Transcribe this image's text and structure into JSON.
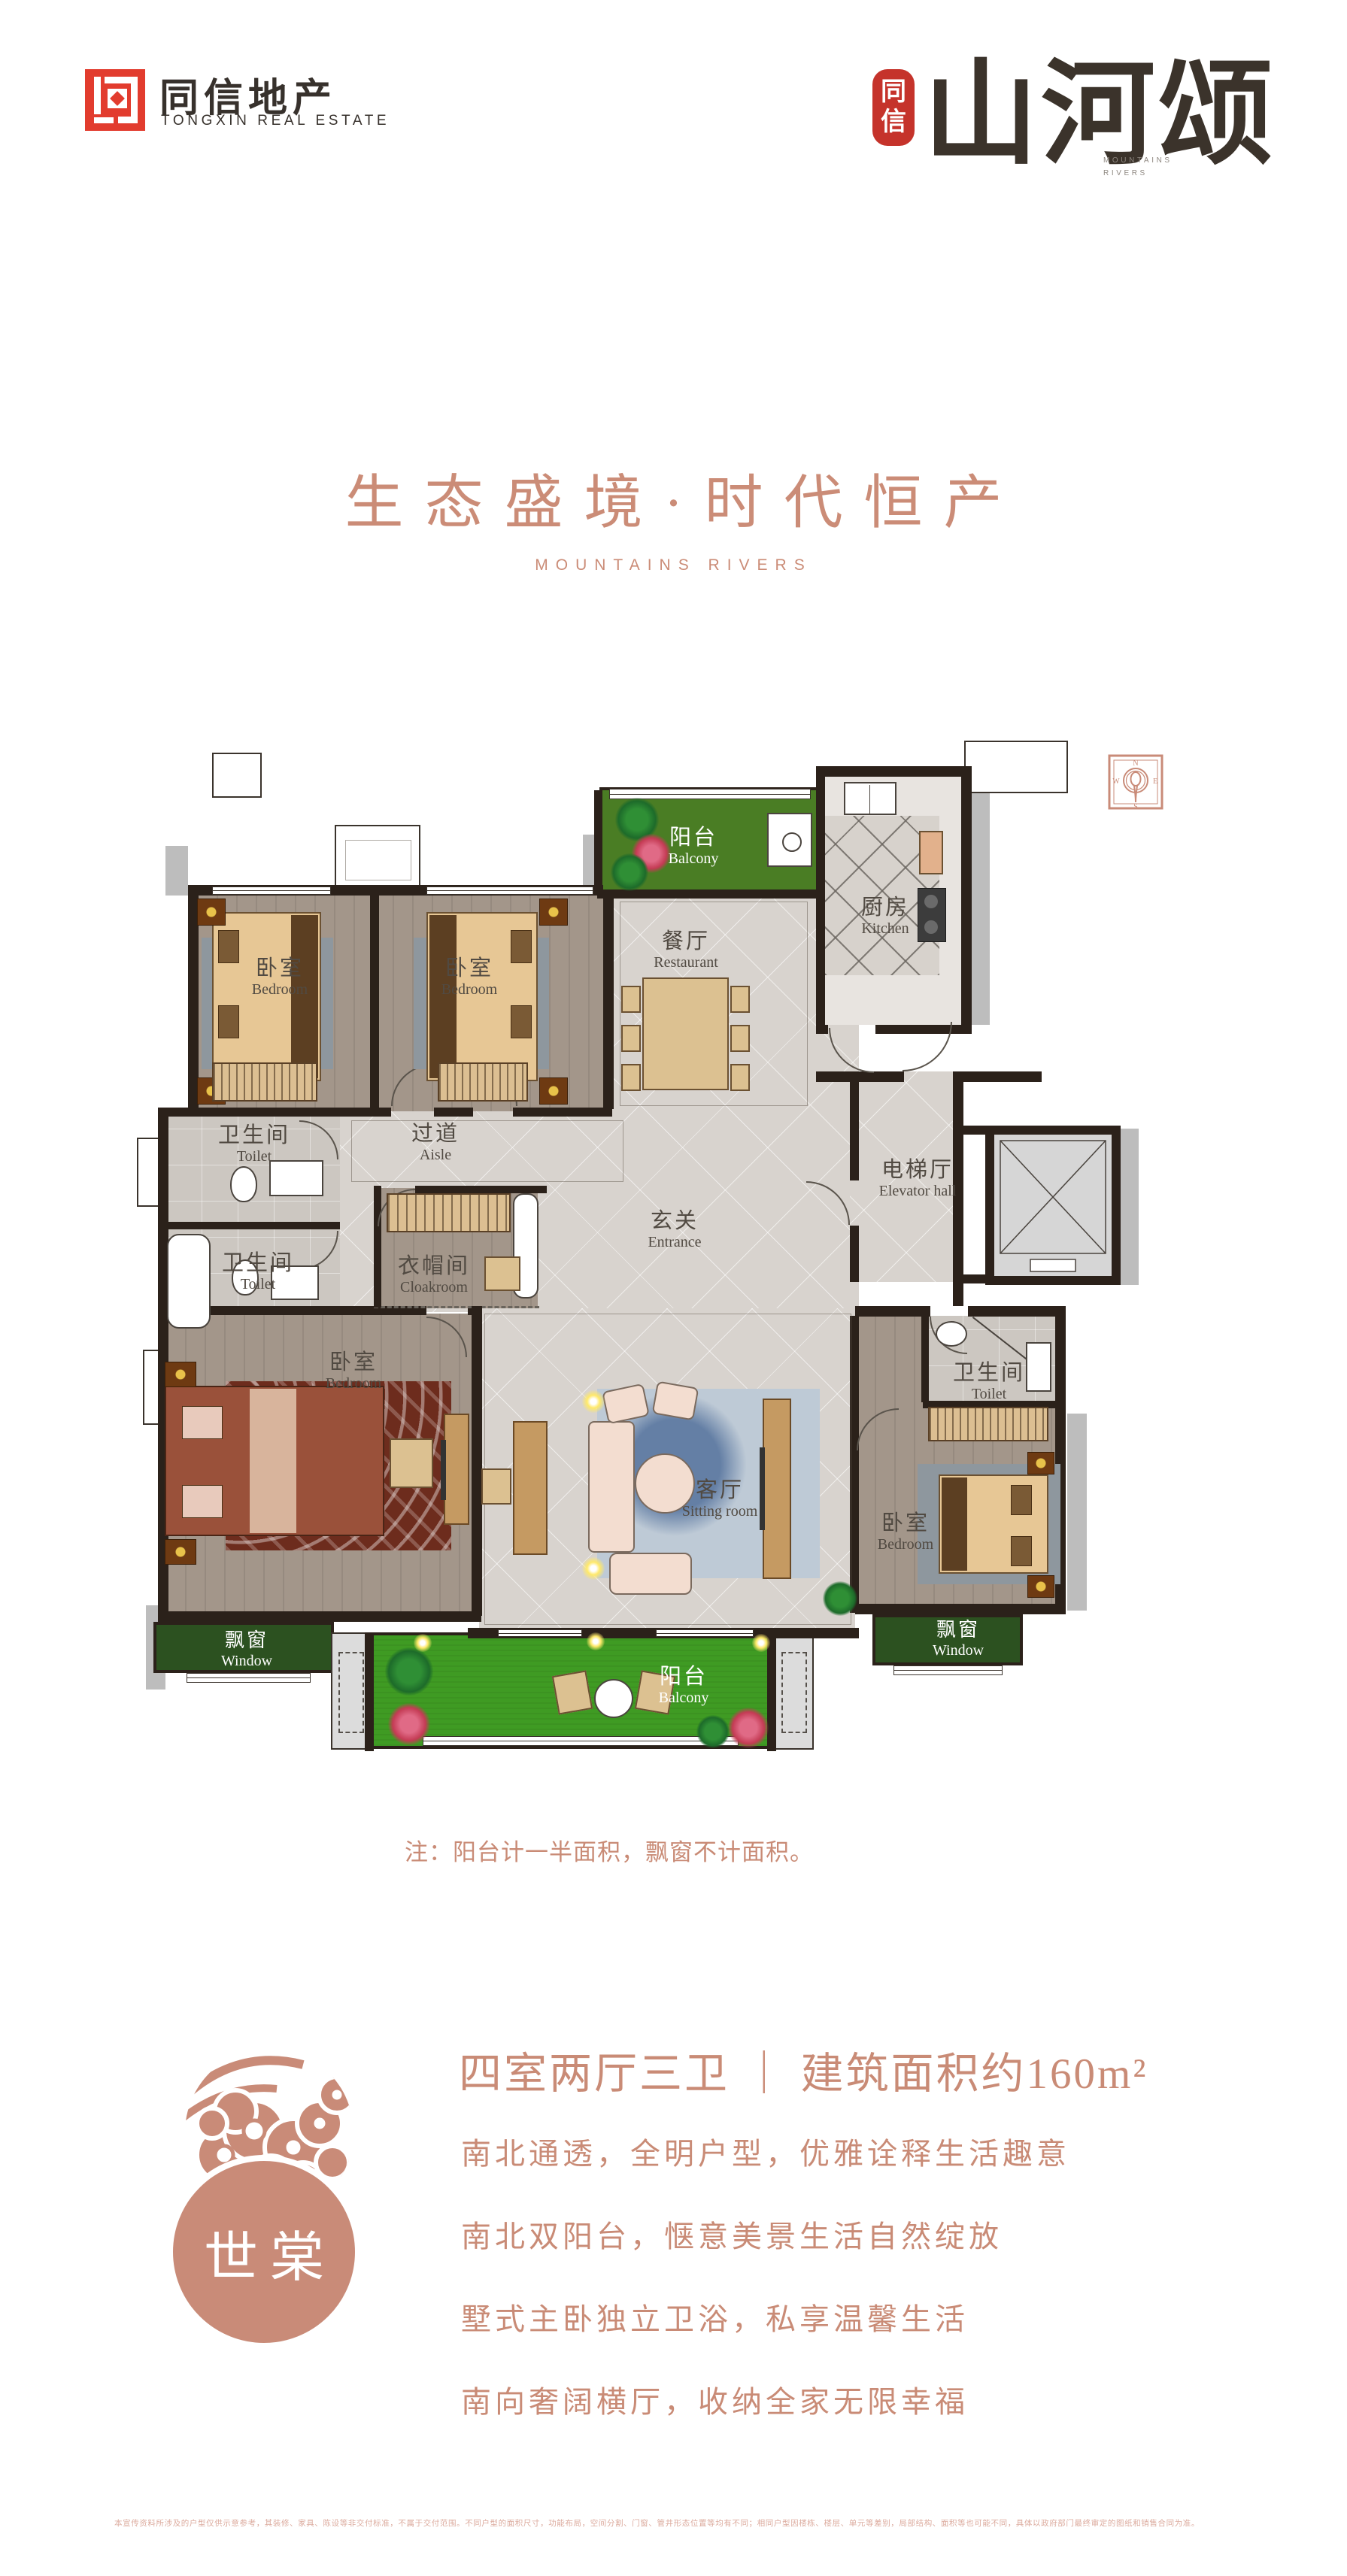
{
  "brand": {
    "logo_zh": "同信地产",
    "logo_en": "TONGXIN REAL ESTATE",
    "seal_top": "同",
    "seal_bottom": "信",
    "calligraphy": "山河颂",
    "calligraphy_sub1": "MOUNTAINS",
    "calligraphy_sub2": "RIVERS"
  },
  "hero": {
    "title": "生态盛境·时代恒产",
    "subtitle": "MOUNTAINS RIVERS"
  },
  "plan": {
    "compass": {
      "n": "N",
      "e": "E",
      "s": "S",
      "w": "W"
    },
    "rooms": {
      "balcony": {
        "zh": "阳台",
        "en": "Balcony"
      },
      "kitchen": {
        "zh": "厨房",
        "en": "Kitchen"
      },
      "restaurant": {
        "zh": "餐厅",
        "en": "Restaurant"
      },
      "bedroom": {
        "zh": "卧室",
        "en": "Bedroom"
      },
      "toilet": {
        "zh": "卫生间",
        "en": "Toilet"
      },
      "aisle": {
        "zh": "过道",
        "en": "Aisle"
      },
      "cloakroom": {
        "zh": "衣帽间",
        "en": "Cloakroom"
      },
      "entrance": {
        "zh": "玄关",
        "en": "Entrance"
      },
      "elevator_hall": {
        "zh": "电梯厅",
        "en": "Elevator hall"
      },
      "sitting_room": {
        "zh": "客厅",
        "en": "Sitting room"
      },
      "window": {
        "zh": "飘窗",
        "en": "Window"
      }
    },
    "note": "注：阳台计一半面积，飘窗不计面积。"
  },
  "unit": {
    "badge": "世棠",
    "headline": "四室两厅三卫 ｜ 建筑面积约160m²",
    "features": [
      "南北通透，全明户型，优雅诠释生活趣意",
      "南北双阳台，惬意美景生活自然绽放",
      "墅式主卧独立卫浴，私享温馨生活",
      "南向奢阔横厅，收纳全家无限幸福"
    ]
  },
  "footer": {
    "disclaimer": "本宣传资料所涉及的户型仅供示意参考，其装修、家具、陈设等非交付标准，不属于交付范围。不同户型的面积尺寸，功能布局，空间分割、门窗、管井形态位置等均有不同；相同户型因楼栋、楼层、单元等差别，局部结构、面积等也可能不同，具体以政府部门最终审定的图纸和销售合同为准。"
  }
}
